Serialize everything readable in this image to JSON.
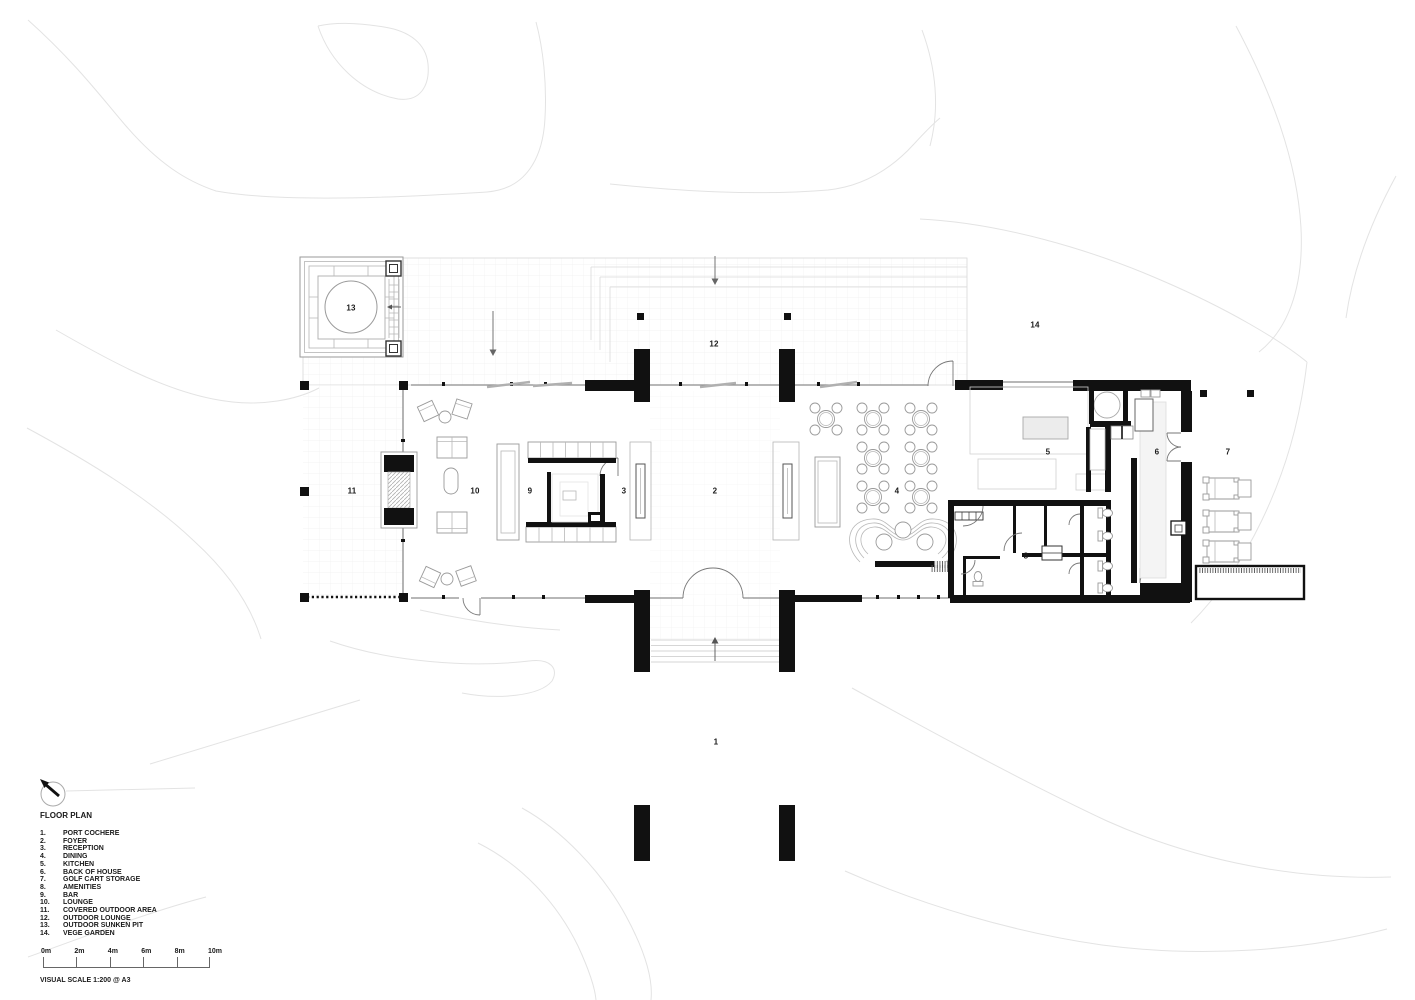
{
  "title": "FLOOR PLAN",
  "rooms": [
    {
      "num": "1",
      "label": "PORT COCHERE"
    },
    {
      "num": "2",
      "label": "FOYER"
    },
    {
      "num": "3",
      "label": "RECEPTION"
    },
    {
      "num": "4",
      "label": "DINING"
    },
    {
      "num": "5",
      "label": "KITCHEN"
    },
    {
      "num": "6",
      "label": "BACK OF HOUSE"
    },
    {
      "num": "7",
      "label": "GOLF CART STORAGE"
    },
    {
      "num": "8",
      "label": "AMENITIES"
    },
    {
      "num": "9",
      "label": "BAR"
    },
    {
      "num": "10",
      "label": "LOUNGE"
    },
    {
      "num": "11",
      "label": "COVERED OUTDOOR AREA"
    },
    {
      "num": "12",
      "label": "OUTDOOR LOUNGE"
    },
    {
      "num": "13",
      "label": "OUTDOOR SUNKEN PIT"
    },
    {
      "num": "14",
      "label": "VEGE GARDEN"
    }
  ],
  "scalebar": {
    "labels": [
      "0m",
      "2m",
      "4m",
      "6m",
      "8m",
      "10m"
    ],
    "note": "VISUAL SCALE 1:200 @ A3"
  },
  "north_indicator": {
    "icon": "north-arrow",
    "direction": "northwest"
  },
  "colors": {
    "wall": "#111111",
    "furniture": "#9a9a9a",
    "site_contour": "#e3e3e3",
    "text": "#1a1a1a"
  }
}
